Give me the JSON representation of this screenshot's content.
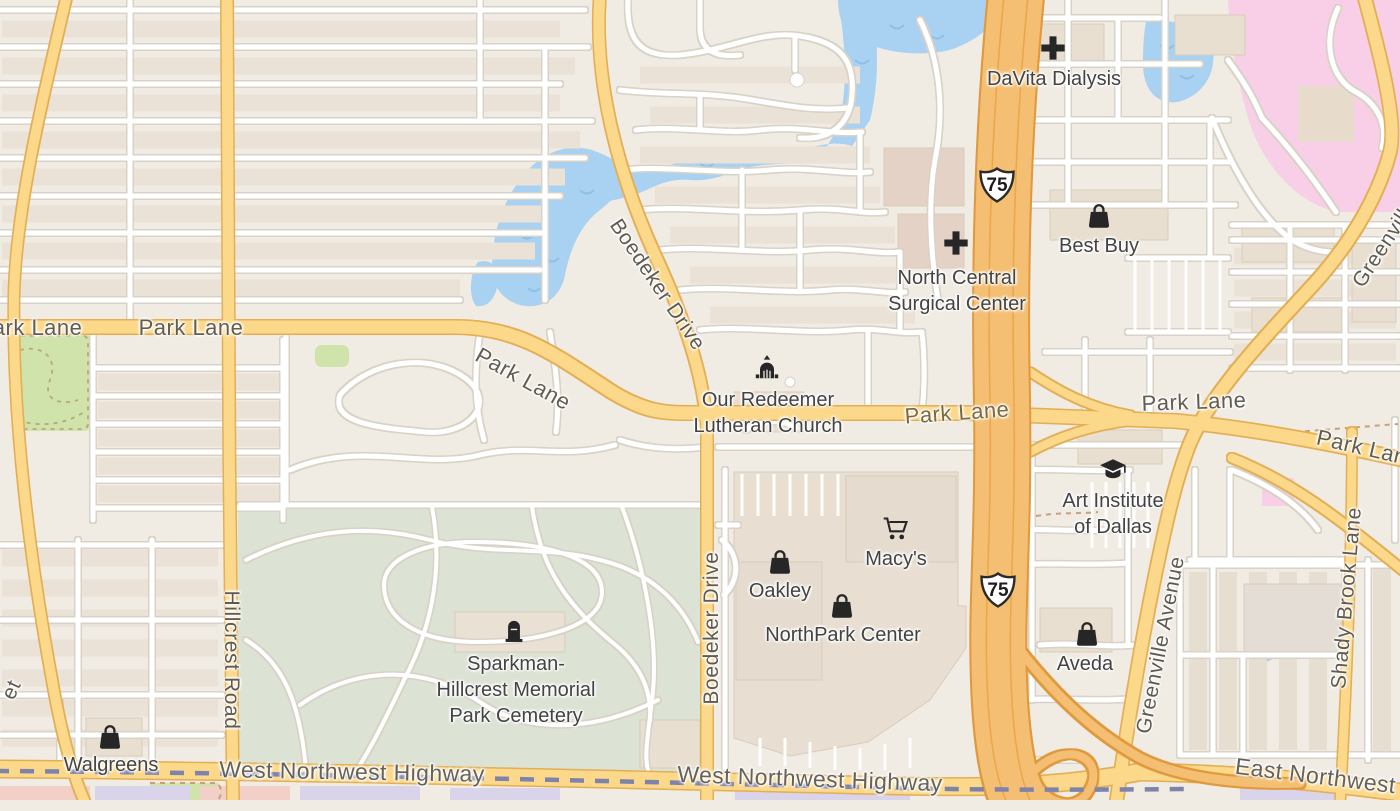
{
  "colors": {
    "background": "#f0ebe3",
    "residential_block": "#ebe2d7",
    "building": "#e9dfd1",
    "road_yellow": "#fbd88a",
    "road_yellow_casing": "#e3af55",
    "highway_orange": "#f4bf72",
    "highway_orange_casing": "#e0993e",
    "water_blue": "#a9d2f2",
    "pink_area": "#f8cfe6",
    "park_green": "#cfe3ab",
    "cemetery_green": "#dce2d4",
    "rail_dash": "#7e83ab",
    "road_label": "#625d51",
    "onroad_label": "#7a6a3e",
    "poi_label": "#434343"
  },
  "highway_shields": [
    {
      "label": "75",
      "x": 997,
      "y": 185
    },
    {
      "label": "75",
      "x": 998,
      "y": 590
    }
  ],
  "road_labels": [
    {
      "text": "Park Lane",
      "x": 30,
      "y": 328,
      "rot": 0,
      "variant": "road-lbl"
    },
    {
      "text": "Park Lane",
      "x": 191,
      "y": 328,
      "rot": 0,
      "variant": "road-lbl"
    },
    {
      "text": "Park Lane",
      "x": 523,
      "y": 379,
      "rot": 29,
      "variant": "road-lbl"
    },
    {
      "text": "Boedeker Drive",
      "x": 657,
      "y": 285,
      "rot": 56,
      "variant": "street-v-lbl"
    },
    {
      "text": "Boedeker Drive",
      "x": 712,
      "y": 628,
      "rot": -90,
      "variant": "street-v-lbl"
    },
    {
      "text": "Hillcrest Road",
      "x": 231,
      "y": 660,
      "rot": 90,
      "variant": "street-v-lbl"
    },
    {
      "text": "Park Lane",
      "x": 957,
      "y": 413,
      "rot": -4,
      "variant": "onroad-lbl"
    },
    {
      "text": "Park Lane",
      "x": 1194,
      "y": 402,
      "rot": -2,
      "variant": "road-lbl"
    },
    {
      "text": "Park Lane",
      "x": 1368,
      "y": 449,
      "rot": 13,
      "variant": "road-lbl"
    },
    {
      "text": "Greenville Avenue",
      "x": 1161,
      "y": 645,
      "rot": -79,
      "variant": "street-v-lbl"
    },
    {
      "text": "Greenville Avenue",
      "x": 1407,
      "y": 210,
      "rot": -57,
      "variant": "street-v-lbl"
    },
    {
      "text": "Shady Brook Lane",
      "x": 1347,
      "y": 598,
      "rot": -85,
      "variant": "street-v-lbl"
    },
    {
      "text": "West Northwest Highway",
      "x": 352,
      "y": 772,
      "rot": 1,
      "variant": "hwy-lbl"
    },
    {
      "text": "West Northwest Highway",
      "x": 810,
      "y": 779,
      "rot": 2,
      "variant": "hwy-lbl"
    },
    {
      "text": "East Northwest Highway",
      "x": 1364,
      "y": 782,
      "rot": 7,
      "variant": "hwy-lbl"
    },
    {
      "text": "et",
      "x": 12,
      "y": 690,
      "rot": -65,
      "variant": "street-v-lbl"
    }
  ],
  "pois": [
    {
      "name": "DaVita Dialysis",
      "lines": [
        "DaVita Dialysis"
      ],
      "lx": 1054,
      "ly": 79,
      "icon": "medical-cross",
      "ix": 1053,
      "iy": 48
    },
    {
      "name": "Best Buy",
      "lines": [
        "Best Buy"
      ],
      "lx": 1099,
      "ly": 246,
      "icon": "shopping-bag",
      "ix": 1099,
      "iy": 216
    },
    {
      "name": "North Central Surgical Center",
      "lines": [
        "North Central",
        "Surgical Center"
      ],
      "lx": 957,
      "ly": 291,
      "icon": "medical-cross",
      "ix": 956,
      "iy": 243
    },
    {
      "name": "Our Redeemer Lutheran Church",
      "lines": [
        "Our Redeemer",
        "Lutheran Church"
      ],
      "lx": 768,
      "ly": 413,
      "icon": "church",
      "ix": 767,
      "iy": 368
    },
    {
      "name": "Art Institute of Dallas",
      "lines": [
        "Art Institute",
        "of Dallas"
      ],
      "lx": 1113,
      "ly": 514,
      "icon": "graduation-cap",
      "ix": 1113,
      "iy": 469
    },
    {
      "name": "Macy's",
      "lines": [
        "Macy's"
      ],
      "lx": 896,
      "ly": 559,
      "icon": "shopping-cart",
      "ix": 896,
      "iy": 529
    },
    {
      "name": "Oakley",
      "lines": [
        "Oakley"
      ],
      "lx": 780,
      "ly": 591,
      "icon": "shopping-bag",
      "ix": 780,
      "iy": 562
    },
    {
      "name": "NorthPark Center",
      "lines": [
        "NorthPark Center"
      ],
      "lx": 843,
      "ly": 635,
      "icon": "shopping-bag",
      "ix": 842,
      "iy": 606
    },
    {
      "name": "Aveda",
      "lines": [
        "Aveda"
      ],
      "lx": 1085,
      "ly": 664,
      "icon": "shopping-bag",
      "ix": 1087,
      "iy": 634
    },
    {
      "name": "Sparkman-Hillcrest Memorial Park Cemetery",
      "lines": [
        "Sparkman-",
        "Hillcrest Memorial",
        "Park Cemetery"
      ],
      "lx": 516,
      "ly": 690,
      "icon": "tombstone",
      "ix": 514,
      "iy": 630
    },
    {
      "name": "Walgreens",
      "lines": [
        "Walgreens"
      ],
      "lx": 111,
      "ly": 765,
      "icon": "shopping-bag",
      "ix": 110,
      "iy": 737
    }
  ]
}
